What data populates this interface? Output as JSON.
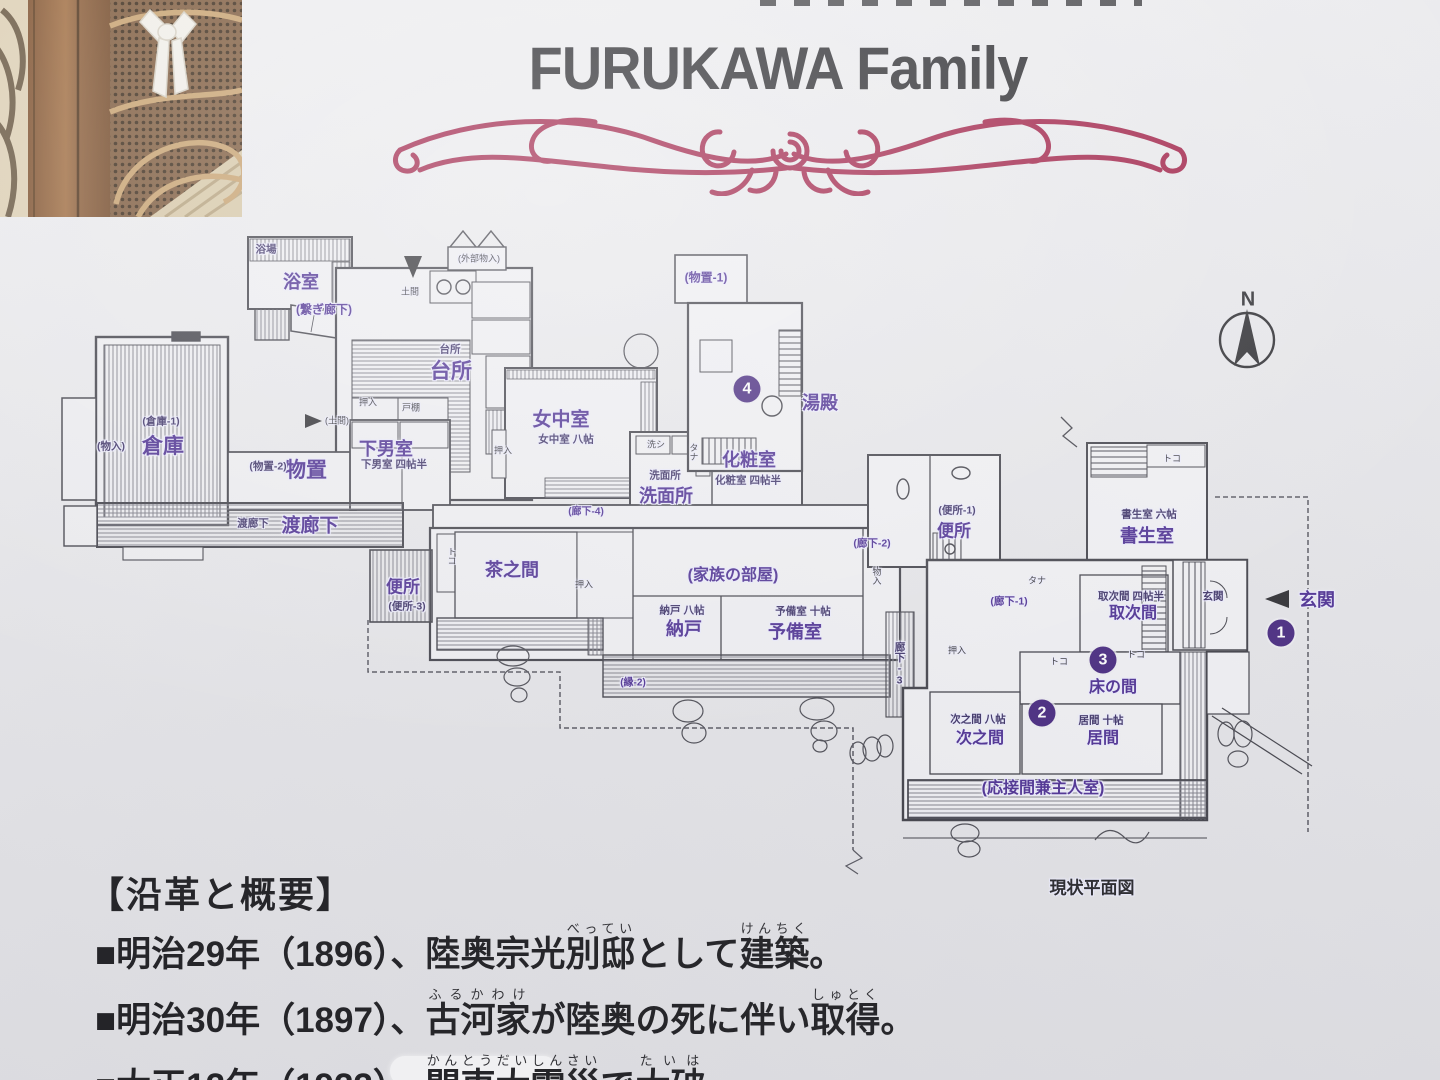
{
  "header": {
    "title": "FURUKAWA Family"
  },
  "compass": {
    "label": "N"
  },
  "flourish_color": "#a01f46",
  "accent_purple": "#4b2d92",
  "plan": {
    "caption": "現状平面図",
    "labels": [
      {
        "t": "浴室",
        "x": 301,
        "y": 281,
        "s": 18,
        "k": "room"
      },
      {
        "t": "台所",
        "x": 451,
        "y": 370,
        "s": 21,
        "k": "room"
      },
      {
        "t": "倉庫",
        "x": 163,
        "y": 445,
        "s": 21,
        "k": "room"
      },
      {
        "t": "物置",
        "x": 306,
        "y": 469,
        "s": 21,
        "k": "room"
      },
      {
        "t": "下男室",
        "x": 386,
        "y": 448,
        "s": 18,
        "k": "room"
      },
      {
        "t": "渡廊下",
        "x": 310,
        "y": 524,
        "s": 19,
        "k": "room"
      },
      {
        "t": "女中室",
        "x": 561,
        "y": 418,
        "s": 19,
        "k": "room"
      },
      {
        "t": "洗面所",
        "x": 666,
        "y": 495,
        "s": 18,
        "k": "room"
      },
      {
        "t": "化粧室",
        "x": 749,
        "y": 459,
        "s": 18,
        "k": "room"
      },
      {
        "t": "湯殿",
        "x": 820,
        "y": 402,
        "s": 18,
        "k": "room"
      },
      {
        "t": "便所",
        "x": 403,
        "y": 585,
        "s": 17,
        "k": "room"
      },
      {
        "t": "茶之間",
        "x": 512,
        "y": 569,
        "s": 18,
        "k": "room"
      },
      {
        "t": "納戸",
        "x": 684,
        "y": 628,
        "s": 18,
        "k": "room"
      },
      {
        "t": "予備室",
        "x": 795,
        "y": 631,
        "s": 18,
        "k": "room"
      },
      {
        "t": "便所",
        "x": 954,
        "y": 529,
        "s": 17,
        "k": "room"
      },
      {
        "t": "書生室",
        "x": 1147,
        "y": 535,
        "s": 18,
        "k": "room"
      },
      {
        "t": "取次間",
        "x": 1133,
        "y": 611,
        "s": 16,
        "k": "room"
      },
      {
        "t": "床の間",
        "x": 1113,
        "y": 685,
        "s": 16,
        "k": "room"
      },
      {
        "t": "次之間",
        "x": 980,
        "y": 736,
        "s": 16,
        "k": "room"
      },
      {
        "t": "居間",
        "x": 1103,
        "y": 736,
        "s": 16,
        "k": "room"
      },
      {
        "t": "玄関",
        "x": 1317,
        "y": 599,
        "s": 18,
        "k": "room",
        "n": "entrance-label"
      },
      {
        "t": "(家族の部屋)",
        "x": 733,
        "y": 573,
        "s": 16,
        "k": "room"
      },
      {
        "t": "(応接間兼主人室)",
        "x": 1043,
        "y": 786,
        "s": 16,
        "k": "room"
      },
      {
        "t": "(繋ぎ廊下)",
        "x": 324,
        "y": 309,
        "s": 12,
        "k": "room"
      },
      {
        "t": "(物置-1)",
        "x": 706,
        "y": 277,
        "s": 12,
        "k": "room"
      },
      {
        "t": "(廊下-2)",
        "x": 872,
        "y": 543,
        "s": 10.5,
        "k": "room"
      },
      {
        "t": "(廊下-1)",
        "x": 1009,
        "y": 601,
        "s": 10.5,
        "k": "room"
      },
      {
        "t": "(廊下-4)",
        "x": 586,
        "y": 510,
        "s": 10,
        "k": "room"
      },
      {
        "t": "(縁-2)",
        "x": 633,
        "y": 681,
        "s": 10,
        "k": "room"
      },
      {
        "t": "玄関",
        "x": 1213,
        "y": 596,
        "k": "sub"
      },
      {
        "t": "廊下-3",
        "x": 900,
        "y": 664,
        "k": "sub",
        "v": 1
      },
      {
        "t": "女中室 八帖",
        "x": 566,
        "y": 439,
        "k": "sub"
      },
      {
        "t": "化粧室 四帖半",
        "x": 748,
        "y": 480,
        "k": "sub"
      },
      {
        "t": "洗面所",
        "x": 665,
        "y": 475,
        "k": "sub"
      },
      {
        "t": "台所",
        "x": 450,
        "y": 349,
        "k": "sub"
      },
      {
        "t": "納戸 八帖",
        "x": 682,
        "y": 610,
        "k": "sub"
      },
      {
        "t": "予備室 十帖",
        "x": 803,
        "y": 611,
        "k": "sub"
      },
      {
        "t": "次之間 八帖",
        "x": 978,
        "y": 719,
        "k": "sub"
      },
      {
        "t": "居間 十帖",
        "x": 1101,
        "y": 720,
        "k": "sub"
      },
      {
        "t": "取次間 四帖半",
        "x": 1131,
        "y": 596,
        "k": "sub"
      },
      {
        "t": "書生室 六帖",
        "x": 1149,
        "y": 514,
        "k": "sub"
      },
      {
        "t": "(便所-1)",
        "x": 957,
        "y": 510,
        "k": "sub"
      },
      {
        "t": "(便所-3)",
        "x": 407,
        "y": 606,
        "k": "sub"
      },
      {
        "t": "(倉庫-1)",
        "x": 161,
        "y": 421,
        "k": "sub"
      },
      {
        "t": "(物置-2)",
        "x": 268,
        "y": 466,
        "k": "sub"
      },
      {
        "t": "(物入)",
        "x": 111,
        "y": 446,
        "k": "sub"
      },
      {
        "t": "下男室 四帖半",
        "x": 394,
        "y": 464,
        "k": "sub"
      },
      {
        "t": "渡廊下",
        "x": 253,
        "y": 523,
        "k": "sub"
      },
      {
        "t": "浴場",
        "x": 266,
        "y": 249,
        "k": "sub"
      },
      {
        "t": "土間",
        "x": 410,
        "y": 291,
        "k": "tiny"
      },
      {
        "t": "(土間)",
        "x": 337,
        "y": 420,
        "k": "tiny"
      },
      {
        "t": "押入",
        "x": 368,
        "y": 402,
        "k": "tiny"
      },
      {
        "t": "戸棚",
        "x": 411,
        "y": 407,
        "k": "tiny"
      },
      {
        "t": "押入",
        "x": 584,
        "y": 584,
        "k": "tiny"
      },
      {
        "t": "押入",
        "x": 503,
        "y": 450,
        "k": "tiny"
      },
      {
        "t": "押入",
        "x": 957,
        "y": 650,
        "k": "tiny"
      },
      {
        "t": "トコ",
        "x": 452,
        "y": 556,
        "k": "tiny",
        "v": 1
      },
      {
        "t": "トコ",
        "x": 1172,
        "y": 458,
        "k": "tiny"
      },
      {
        "t": "トコ",
        "x": 1059,
        "y": 661,
        "k": "tiny"
      },
      {
        "t": "トコ",
        "x": 1136,
        "y": 654,
        "k": "tiny"
      },
      {
        "t": "タナ",
        "x": 1037,
        "y": 580,
        "k": "tiny"
      },
      {
        "t": "物入",
        "x": 877,
        "y": 576,
        "k": "tiny",
        "v": 1
      },
      {
        "t": "(外部物入)",
        "x": 479,
        "y": 258,
        "k": "tiny"
      },
      {
        "t": "洗シ",
        "x": 656,
        "y": 444,
        "k": "tiny"
      },
      {
        "t": "タナ",
        "x": 694,
        "y": 452,
        "k": "tiny",
        "v": 1
      },
      {
        "t": "現状平面図",
        "x": 1092,
        "y": 886,
        "s": 17,
        "k": "cap"
      },
      {
        "t": "N",
        "x": 1248,
        "y": 300,
        "s": 20,
        "k": "ntext"
      }
    ],
    "markers": [
      {
        "n": "4",
        "x": 747,
        "y": 389
      },
      {
        "n": "1",
        "x": 1281,
        "y": 633
      },
      {
        "n": "3",
        "x": 1103,
        "y": 660
      },
      {
        "n": "2",
        "x": 1042,
        "y": 713
      }
    ]
  },
  "history": {
    "heading": "【沿革と概要】",
    "lines": [
      [
        {
          "t": "■明治29年（1896）、陸奥宗光"
        },
        {
          "t": "別邸",
          "r": "べってい"
        },
        {
          "t": "として"
        },
        {
          "t": "建築",
          "r": "けんちく"
        },
        {
          "t": "。"
        }
      ],
      [
        {
          "t": "■明治30年（1897）、"
        },
        {
          "t": "古河家",
          "r": "ふるかわけ"
        },
        {
          "t": "が陸奥の死に伴い"
        },
        {
          "t": "取得",
          "r": "しゅとく"
        },
        {
          "t": "。"
        }
      ],
      [
        {
          "t": "■大正12年（1923）、"
        },
        {
          "t": "関東大震災",
          "r": "かんとうだいしんさい"
        },
        {
          "t": "で"
        },
        {
          "t": "大破",
          "r": "たいは"
        },
        {
          "t": "。"
        }
      ]
    ]
  }
}
